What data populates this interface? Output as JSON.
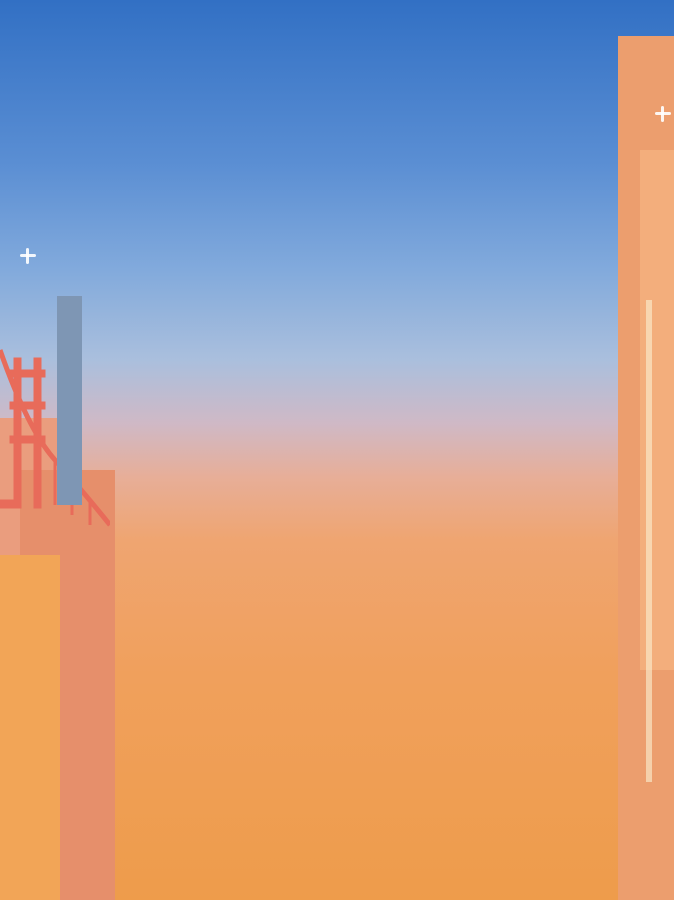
{
  "app": {
    "name": "pixel-tower-building-game",
    "scene": "tower cross-section at sunset"
  },
  "palette": {
    "skyTop": "#3270c4",
    "skyBot": "#ee9c4b",
    "frame": "#f0eae0",
    "frameEdge": "#d9d2c4",
    "darkCeil": "#38312a",
    "darkWall": "#5f574d",
    "trim": "#f6b71c",
    "darkBand": "#b3ada3",
    "darkCab": "#463e35",
    "creamWall": "#e5dfd0",
    "creamBand": "#cfc6b0",
    "creamBandEdge": "#b2a88e",
    "rail": "#2d2d2d",
    "grayCeil": "#77736e",
    "grayWall": "#8f8d8a",
    "grayBand": "#a5a19a",
    "oliveDesk": "#9a9a64",
    "restCeil": "#757068",
    "restWall": "#918c86",
    "windowWhite": "#f6f4f0",
    "benchOrange": "#f09a28",
    "counterYellow": "#e7b93c",
    "starGold": "#e8b838",
    "solarFrame": "#f2ede3",
    "cell": "#a9bfd9",
    "cellLight": "#c3d5e9",
    "platTop": "#5e7da6",
    "platGlass": "#8ba6c6",
    "deskWhite": "#f4f2ec",
    "wood": "#b98b55",
    "ink": "#181818",
    "monitor": "#1c1c1c",
    "cityA": "#ea9d7e",
    "cityB": "#e68f6b",
    "cityC": "#f2a557",
    "cityD": "#f5b460",
    "cityE": "#ec9e6e",
    "cityF": "#f3ae7c",
    "glassBld": "#7e96b4",
    "bridge": "#e86b5a",
    "boardFill": "#e6eedb",
    "boardLine": "#b8cc9c",
    "plantGreen": "#8aa860",
    "potBrown": "#7a4e2a",
    "bouquetYellow": "#e8d84a",
    "vaseGreen": "#7a8a4a",
    "cabOrange": "#f0a028",
    "fileGray": "#8f8f7c"
  },
  "side_elements": [
    {
      "name": "solar-panel-top-left"
    },
    {
      "name": "solar-panel-top-right"
    },
    {
      "name": "solar-panel-bottom-right"
    },
    {
      "name": "window-washing-platform"
    },
    {
      "name": "cable-rig-left"
    },
    {
      "name": "counterweight-panel"
    },
    {
      "name": "balcony-left"
    },
    {
      "name": "golden-gate-bridge"
    },
    {
      "name": "city-skyline"
    }
  ],
  "floors": [
    {
      "id": "top-cutoff",
      "kind": "cutoff",
      "items": [
        {
          "t": "deskrow"
        },
        {
          "t": "deskrow"
        },
        {
          "t": "deskrow"
        },
        {
          "t": "deskrow"
        },
        {
          "t": "deskrow"
        }
      ]
    },
    {
      "id": "executive-suite",
      "kind": "dark",
      "items": [
        {
          "t": "worker",
          "name": "sleepy-gray-haired-manager",
          "hair": "#8d8674",
          "hairStyle": "messy",
          "skin": "#ecd2a8",
          "top": "#70704e",
          "collar": "#f4f2ec",
          "facing": "right"
        },
        {
          "t": "cabinet"
        },
        {
          "t": "worker",
          "name": "peter-pan-costume-worker",
          "hat": "cap",
          "hatColor": "#2f9e3a",
          "feather": "#d23b2a",
          "hair": "#e8641c",
          "skin": "#f6d7ae",
          "top": "#3fae3f",
          "facing": "left"
        },
        {
          "t": "bouquet"
        },
        {
          "t": "worker",
          "name": "blonde-worker-with-dog",
          "hair": "#f3d98b",
          "hairStyle": "long",
          "skin": "#f8ddb6",
          "top": "#efe7d0",
          "pet": "#d9913f",
          "facing": "left"
        },
        {
          "t": "worker",
          "name": "suited-worker-with-glasses",
          "hair": "#17120e",
          "skin": "#7a4a22",
          "top": "#1d1b1e",
          "collar": "#f4f2ec",
          "glasses": "#cfd8dc",
          "facing": "left"
        }
      ]
    },
    {
      "id": "office-level-2",
      "kind": "cream",
      "items": [
        {
          "t": "worker",
          "name": "gray-haired-suit-worker",
          "hair": "#9c9c98",
          "skin": "#eccfa4",
          "top": "#8d8d95",
          "tie": "#7a4e22",
          "facing": "right"
        },
        {
          "t": "shelf"
        },
        {
          "t": "worker",
          "name": "dark-haired-worker-red-top",
          "hair": "#2b2320",
          "skin": "#efd2a6",
          "top": "#cf5a35",
          "facing": "right"
        },
        {
          "t": "floorlamp"
        },
        {
          "t": "worker",
          "name": "bunny-hood-worker",
          "hat": "ears",
          "hatColor": "#f4aebc",
          "hair": "#6b4a2a",
          "skin": "#f6d7ae",
          "top": "#eda4b4",
          "facing": "left"
        },
        {
          "t": "shelf"
        },
        {
          "t": "worker",
          "name": "red-haired-worker-white-top",
          "hair": "#c94f46",
          "skin": "#f6d7ae",
          "top": "#f0eee6",
          "facing": "left"
        }
      ]
    },
    {
      "id": "costume-floor",
      "kind": "dark",
      "items": [
        {
          "t": "worker",
          "name": "tiger-costume-worker",
          "mask": "tiger",
          "maskColor": "#e08a28",
          "skin": "#f6d7ae",
          "top": "#7a5a2e",
          "facing": "right"
        },
        {
          "t": "worker",
          "name": "flower-crown-worker",
          "hat": "flowers",
          "hatColor": "#a06ec8",
          "hair": "#4aa878",
          "skin": "#7a4a22",
          "top": "#cc6eb8",
          "facing": "right"
        },
        {
          "t": "bouquet"
        },
        {
          "t": "worker",
          "name": "shark-hood-worker",
          "mask": "shark",
          "maskColor": "#9ed4ec",
          "skin": "#f8dcc0",
          "top": "#aadcf0",
          "facing": "left"
        },
        {
          "t": "worker",
          "name": "pumpkin-witch-worker",
          "mask": "pumpkin",
          "maskColor": "#e87818",
          "hatColor": "#16161a",
          "skin": "#f6d7ae",
          "top": "#1d1b1e",
          "facing": "left"
        }
      ]
    },
    {
      "id": "office-level-4",
      "kind": "cream",
      "items": [
        {
          "t": "worker",
          "name": "hard-hat-worker",
          "hat": "dome",
          "hatColor": "#f0c828",
          "hair": "#7a5228",
          "skin": "#f6d0a0",
          "top": "#4caf50",
          "facing": "right"
        },
        {
          "t": "shelf"
        },
        {
          "t": "worker",
          "name": "blonde-worker-with-cat",
          "hair": "#f5e29a",
          "hairStyle": "long",
          "skin": "#fadfbe",
          "top": "#f3efe2",
          "pet": "#d9913f",
          "facing": "right"
        },
        {
          "t": "floorlamp"
        },
        {
          "t": "worker",
          "name": "burger-hat-worker",
          "hat": "burger",
          "hatColor": "#f0a828",
          "hair": "#e08ad8",
          "hairStyle": "long",
          "skin": "#9a5c28",
          "top": "#f0eee6",
          "tie": "#4a6ed0",
          "facing": "left"
        },
        {
          "t": "shelf"
        },
        {
          "t": "worker",
          "name": "green-haired-overalls-worker",
          "hair": "#6abf4a",
          "skin": "#f8d8b0",
          "top": "#f08428",
          "facing": "left"
        }
      ]
    },
    {
      "id": "gray-office",
      "kind": "gray",
      "items": [
        {
          "t": "worker",
          "name": "purple-haired-worker",
          "hair": "#8a2cc0",
          "hairStyle": "big",
          "skin": "#caa06c",
          "top": "#26222a",
          "facing": "right"
        },
        {
          "t": "board"
        },
        {
          "t": "worker",
          "name": "red-petal-costume-worker",
          "mask": "petals",
          "maskColor": "#d03028",
          "skin": "#7a4a22",
          "top": "#2e7a2e",
          "facing": "right"
        },
        {
          "t": "tvcab"
        },
        {
          "t": "worker",
          "name": "red-haired-worker-skirt",
          "hair": "#d04038",
          "skin": "#f2d4aa",
          "top": "#f2efe6",
          "facing": "right"
        },
        {
          "t": "board"
        },
        {
          "t": "orangecab"
        },
        {
          "t": "worker",
          "name": "grandma-worker",
          "hair": "#eceaea",
          "hairStyle": "big",
          "skin": "#ecd0ac",
          "top": "#9c5cb0",
          "facing": "left"
        }
      ]
    },
    {
      "id": "office-level-6",
      "kind": "cream",
      "items": [
        {
          "t": "worker",
          "name": "flower-covered-worker",
          "mask": "tree",
          "maskColor": "#8a5a28",
          "skin": "#b88a58",
          "top": "#7a4e22",
          "facing": "right"
        },
        {
          "t": "shelf"
        },
        {
          "t": "worker",
          "name": "curly-haired-suit-worker",
          "hair": "#7a4e22",
          "hairStyle": "big",
          "skin": "#f2d0a0",
          "top": "#8d8d95",
          "tie": "#4a3624",
          "facing": "right"
        },
        {
          "t": "floorlamp"
        },
        {
          "t": "worker",
          "name": "green-jacket-blonde-worker",
          "hair": "#e8d070",
          "skin": "#f6d6ac",
          "top": "#58b048",
          "facing": "left"
        },
        {
          "t": "shelf"
        },
        {
          "t": "worker",
          "name": "red-flower-hat-worker",
          "hat": "flowerdot",
          "hatColor": "#d02820",
          "brim": "#c89858",
          "hair": "#6b4226",
          "skin": "#b87838",
          "top": "#cf4a3a",
          "glasses": "#1a1a1a",
          "facing": "left"
        }
      ]
    },
    {
      "id": "restaurant",
      "kind": "restaurant",
      "items": [
        {
          "t": "stand",
          "name": "white-haired-patron",
          "hair": "#f6f6f4",
          "hairStyle": "big",
          "skin": "#f4e2cc",
          "top": "#e8e4da"
        },
        {
          "t": "bench"
        },
        {
          "t": "stand",
          "name": "waiter",
          "hair": "#6a4420",
          "skin": "#f2d0a0",
          "top": "#f4f2ee",
          "vest": "#1e1e22"
        },
        {
          "t": "counter"
        },
        {
          "t": "plant"
        },
        {
          "t": "stand",
          "name": "green-shirt-patron",
          "hair": "#7a5228",
          "skin": "#f2cfae",
          "top": "#7aa848"
        },
        {
          "t": "bench"
        },
        {
          "t": "stand",
          "name": "bull-costume-patron",
          "mask": "horns",
          "maskColor": "#b8743c",
          "skin": "#d29a6a",
          "top": "#1e1e22",
          "tie": "#c42020"
        },
        {
          "t": "counter"
        }
      ]
    }
  ]
}
